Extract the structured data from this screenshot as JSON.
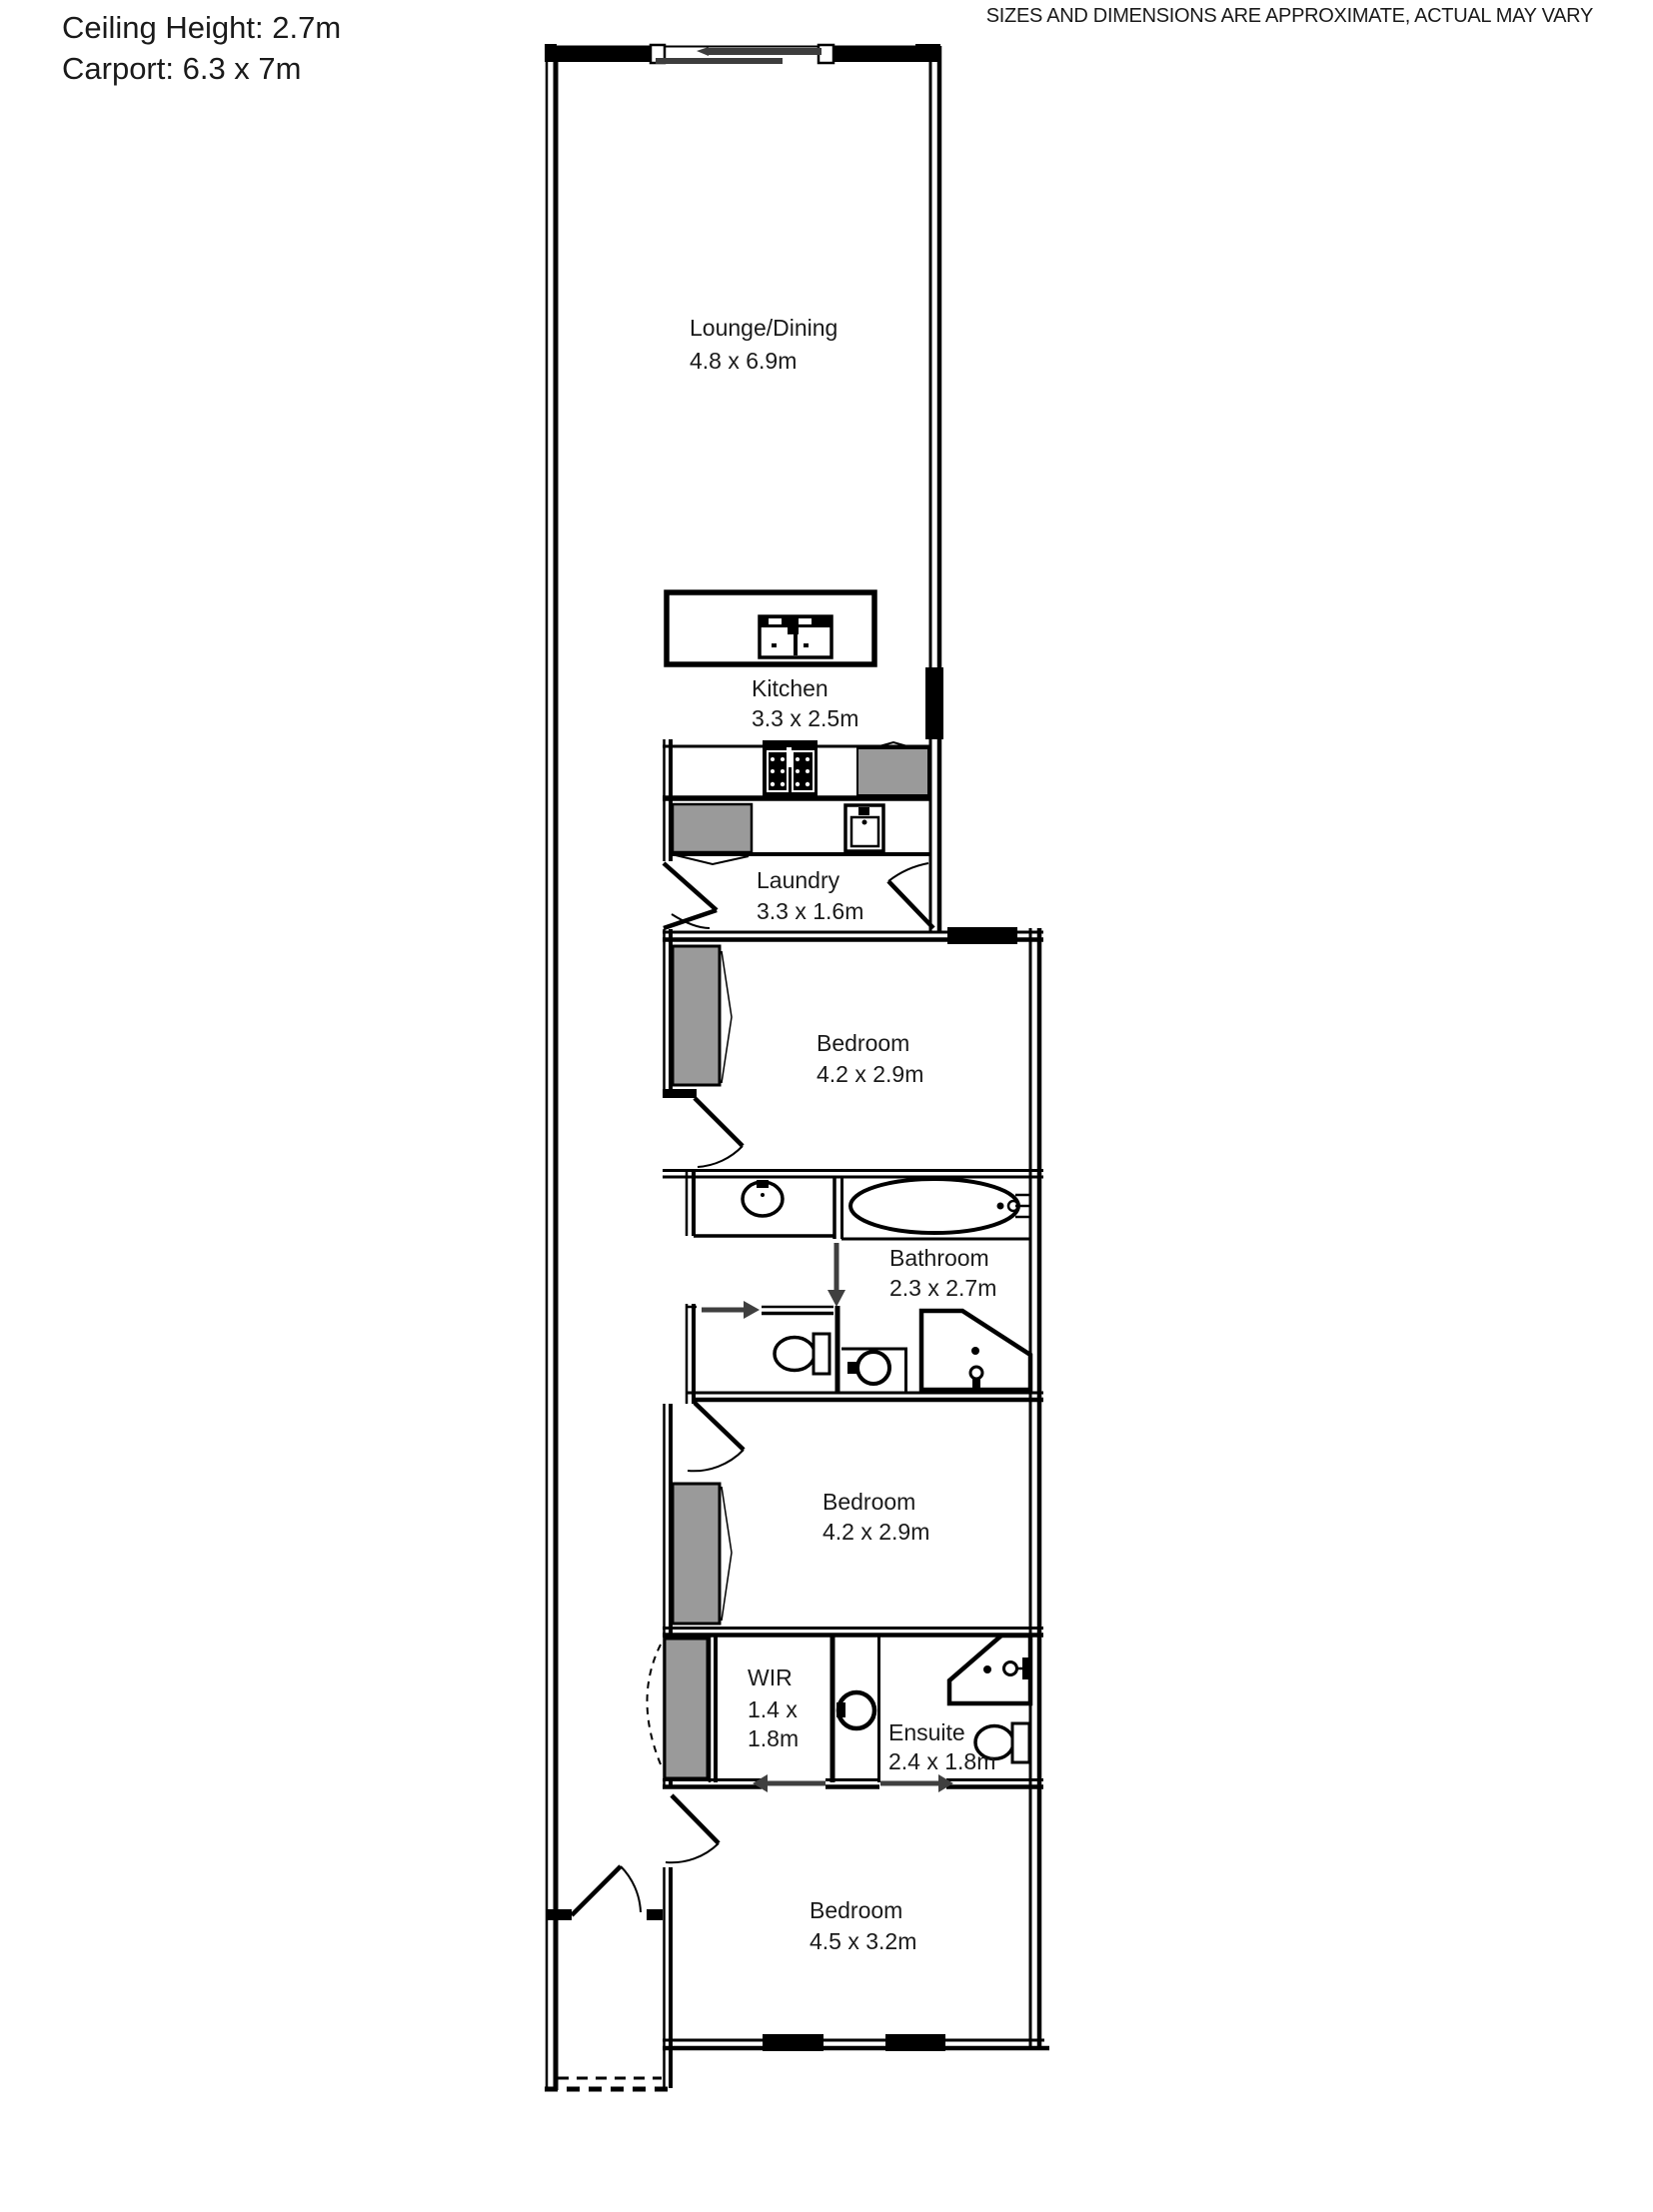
{
  "annotations": {
    "ceiling": "Ceiling Height: 2.7m",
    "carport": "Carport: 6.3 x 7m",
    "disclaimer": "SIZES AND DIMENSIONS ARE APPROXIMATE, ACTUAL MAY VARY"
  },
  "rooms": {
    "lounge": {
      "name": "Lounge/Dining",
      "dims": "4.8 x 6.9m"
    },
    "kitchen": {
      "name": "Kitchen",
      "dims": "3.3 x 2.5m"
    },
    "laundry": {
      "name": "Laundry",
      "dims": "3.3 x 1.6m"
    },
    "bedroom1": {
      "name": "Bedroom",
      "dims": "4.2 x 2.9m"
    },
    "bathroom": {
      "name": "Bathroom",
      "dims": "2.3 x 2.7m"
    },
    "bedroom2": {
      "name": "Bedroom",
      "dims": "4.2 x 2.9m"
    },
    "wir": {
      "name": "WIR",
      "dims_line1": "1.4 x",
      "dims_line2": "1.8m"
    },
    "ensuite": {
      "name": "Ensuite",
      "dims": "2.4 x 1.8m"
    },
    "bedroom3": {
      "name": "Bedroom",
      "dims": "4.5 x 3.2m"
    }
  },
  "fixtures": [
    "kitchen-island",
    "island-sink",
    "cooktop",
    "fridge-space",
    "laundry-bench",
    "laundry-sink",
    "wardrobe",
    "vanity-basin",
    "bathtub",
    "toilet",
    "corner-shower",
    "linen-robe"
  ],
  "colors": {
    "wall": "#000000",
    "robe_fill": "#9a9a9a",
    "slider": "#3d3d3d",
    "arrow": "#3f3f3f",
    "text": "#1a1a1a"
  }
}
